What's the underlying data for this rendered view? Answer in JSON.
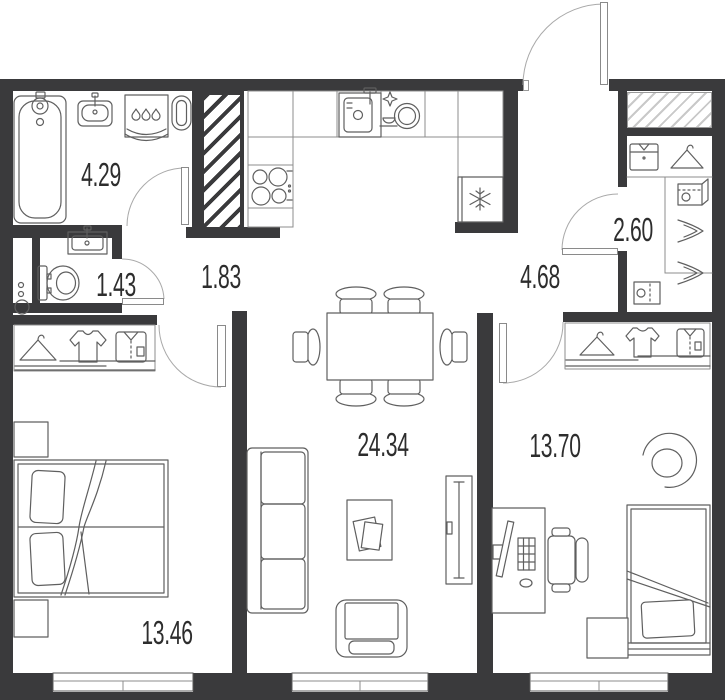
{
  "plan": {
    "title": "apartment-floor-plan",
    "rooms": {
      "bathroom": {
        "area": "4.29"
      },
      "wc": {
        "area": "1.43"
      },
      "hall": {
        "area": "1.83"
      },
      "entry_hall": {
        "area": "4.68"
      },
      "wardrobe": {
        "area": "2.60"
      },
      "living_kitchen": {
        "area": "24.34"
      },
      "bedroom_right": {
        "area": "13.70"
      },
      "bedroom_left": {
        "area": "13.46"
      }
    },
    "fixtures": {
      "bathroom": [
        "bathtub-icon",
        "washbasin-icon",
        "washing-machine-icon",
        "towel-rail-icon"
      ],
      "wc": [
        "sink-icon",
        "toilet-icon",
        "pipe-riser-icon"
      ],
      "kitchen": [
        "hob-icon",
        "kitchen-sink-icon",
        "dishwasher-icon",
        "fridge-icon"
      ],
      "wardrobes": [
        "hanger-icon",
        "tshirt-icon",
        "shirt-icon",
        "folded-shirt-icon",
        "shoes-icon",
        "box-icon"
      ],
      "living": [
        "dining-table-icon",
        "chair-icon",
        "sofa-icon",
        "coffee-table-icon",
        "tv-stand-icon",
        "armchair-icon"
      ],
      "bedroom_left": [
        "double-bed-icon",
        "nightstand-icon"
      ],
      "bedroom_right": [
        "single-bed-icon",
        "desk-icon",
        "office-chair-icon",
        "round-chair-icon",
        "side-table-icon"
      ]
    },
    "colors": {
      "wall": "#3a3a3c",
      "furniture": "#5f5f5f",
      "hatch_light": "#c9c9c9",
      "label": "#2d2d2d",
      "door_arc": "#a9a9a9",
      "background": "#ffffff"
    }
  }
}
